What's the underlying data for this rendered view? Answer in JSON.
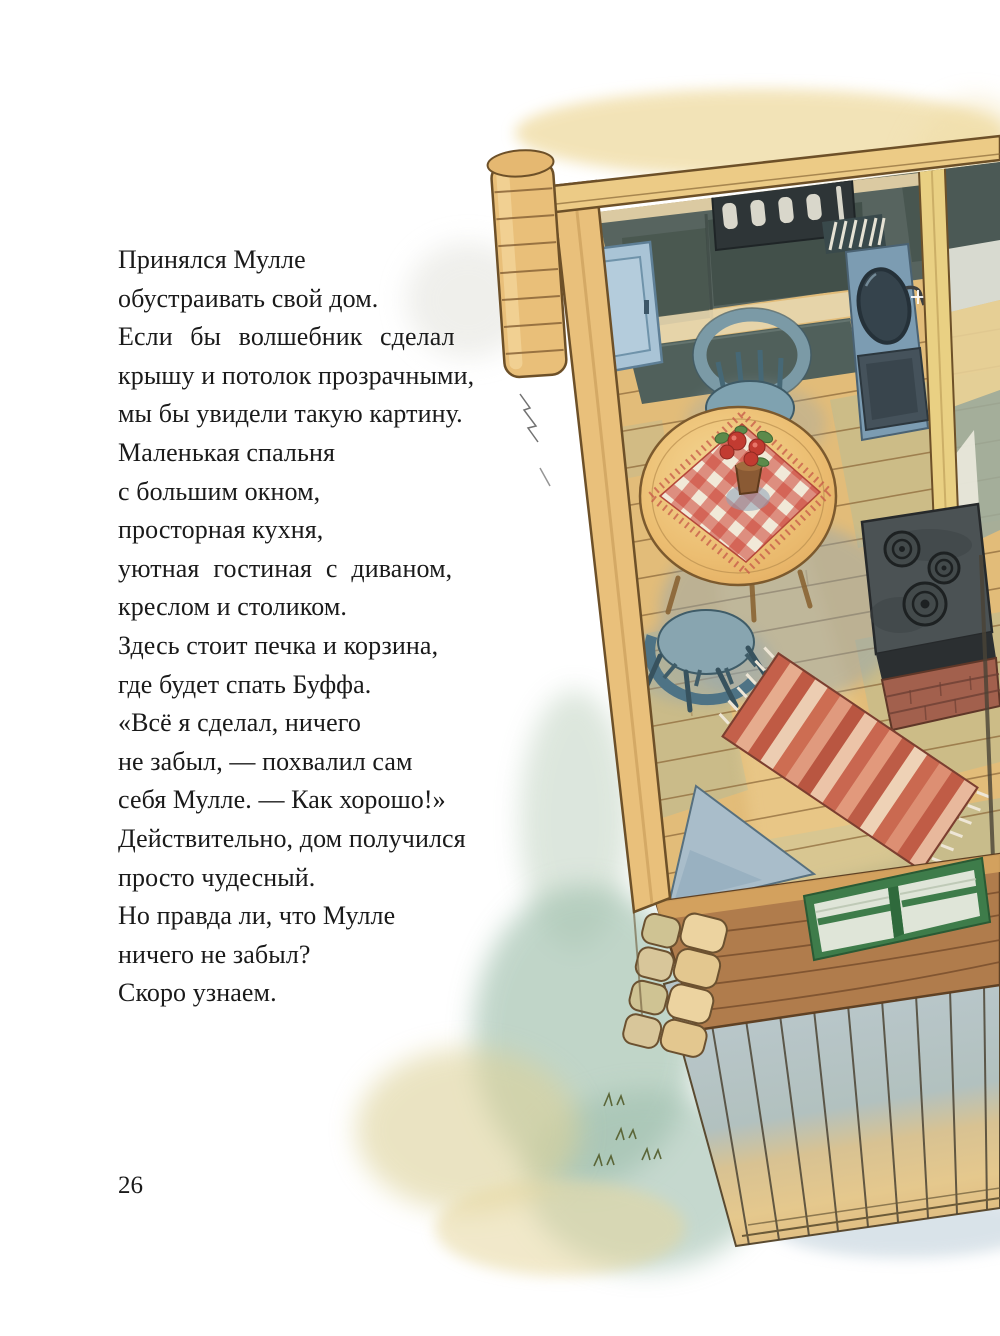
{
  "page": {
    "number": "26",
    "lines": [
      "Принялся Мулле",
      "обустраивать свой дом.",
      "Если бы волшебник сделал",
      "крышу и потолок прозрачными,",
      "мы бы увидели такую картину.",
      "Маленькая спальня",
      "с большим окном,",
      "просторная кухня,",
      "уютная гостиная с диваном,",
      "креслом и столиком.",
      "Здесь стоит печка и корзина,",
      "где будет спать Буффа.",
      "«Всё я сделал, ничего",
      "не забыл, — похвалил сам",
      "себя Мулле. — Как хорошо!»",
      "Действительно, дом получился",
      "просто чудесный.",
      "Но правда ли, что Мулле",
      "ничего не забыл?",
      "Скоро узнаем."
    ]
  },
  "illustration": {
    "description": "Watercolor bird's-eye view of Mulle's log cabin: kitchen with jar shelf, blue cabinet, sink, round table with red gingham cloth and flower pot, two blue chairs, black stove on brick base, striped rag rug, blue triangle cloth, front log wall with green window box and wooden porch deck",
    "palette": {
      "beam_wood": "#e9c07b",
      "wall_dark_teal": "#4f5d58",
      "floor_tan": "#e2bc79",
      "floor_green": "#adbb9e",
      "cabinet_blue": "#a9c4d6",
      "sink_blue": "#7c9cb2",
      "chair_blue": "#7fa2b0",
      "table_top": "#e9b96b",
      "cloth_red": "#cc4a3c",
      "stove_dark": "#4b5254",
      "brick_red": "#a2604d",
      "rug_salmon": "#d9896c",
      "front_wall_brown": "#b07c4c",
      "window_green": "#3e7c4a",
      "deck_blue_gray": "#b7c6c9",
      "deck_tan": "#e2bf83",
      "wash_yellow": "#f0dda6",
      "wash_teal": "#9fbfae"
    }
  }
}
